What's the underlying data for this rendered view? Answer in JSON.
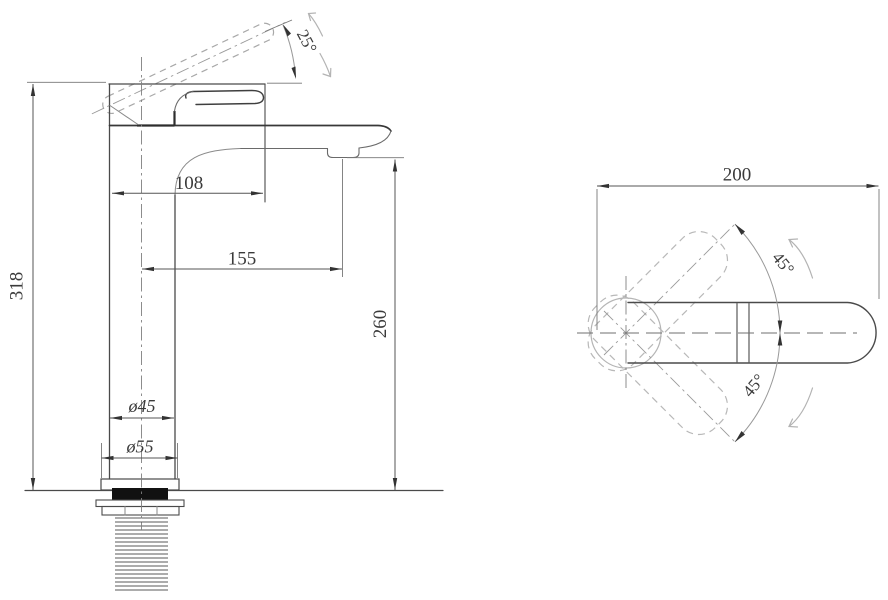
{
  "drawing": {
    "type": "faucet technical drawing",
    "background": "#ffffff",
    "line_color": "#4a4a4a",
    "side_view": {
      "dims": {
        "total_height": "318",
        "spout_top_reach": "108",
        "spout_reach": "155",
        "spout_height": "260",
        "body_diameter": "ø45",
        "base_diameter": "ø55",
        "handle_angle": "25°"
      }
    },
    "top_view": {
      "dims": {
        "overall_length": "200",
        "swivel_upper": "45°",
        "swivel_lower": "45°"
      }
    }
  }
}
